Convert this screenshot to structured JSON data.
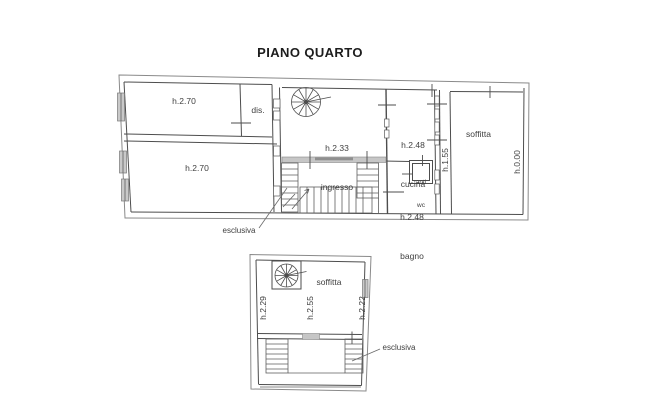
{
  "title": "PIANO QUARTO",
  "upper_plan": {
    "room_top_left": {
      "height": "h.2.70"
    },
    "room_dis": {
      "name": "dis."
    },
    "room_bottom_left": {
      "height": "h.2.70"
    },
    "ingresso": {
      "height": "h.2.33",
      "name": "ingresso"
    },
    "cucina": {
      "height": "h.2.48",
      "name": "cucina"
    },
    "anti_wc": {
      "line1": "anti",
      "line2": "wc"
    },
    "bagno": {
      "height": "h.2.48",
      "name": "bagno"
    },
    "soffitta": {
      "name": "soffitta"
    },
    "height_edge_inner": "h.1.55",
    "height_edge_outer": "h.0.00",
    "stair_annotation": "esclusiva"
  },
  "lower_plan": {
    "soffitta": {
      "name": "soffitta"
    },
    "height_left": "h.2.29",
    "height_middle": "h.2.55",
    "height_right": "h.2.22",
    "stair_annotation": "esclusiva"
  },
  "colors": {
    "background": "#ffffff",
    "line": "#4d4d4d",
    "outer_line": "#8a8a8a",
    "text": "#3f3f3f",
    "landing_fill": "#c6c6c6",
    "window_fill": "#c9c9c9"
  }
}
